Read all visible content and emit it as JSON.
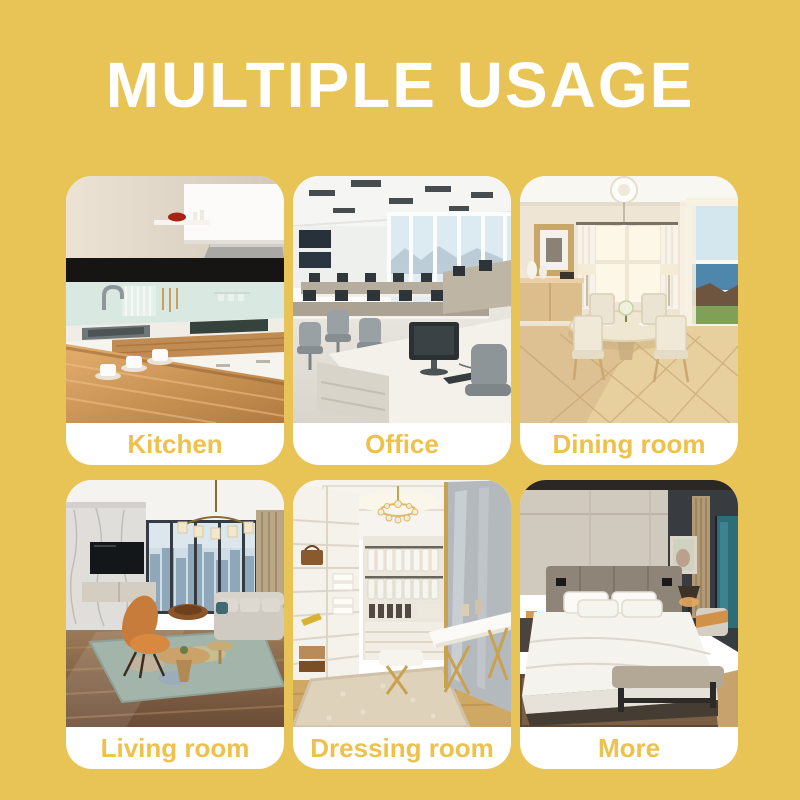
{
  "page": {
    "title": "MULTIPLE USAGE"
  },
  "theme": {
    "background": "#E8C457",
    "title_color": "#FFFFFF",
    "label_color": "#EEC14D",
    "card_background": "#FFFFFF"
  },
  "cards": [
    {
      "label": "Kitchen"
    },
    {
      "label": "Office"
    },
    {
      "label": "Dining room"
    },
    {
      "label": "Living room"
    },
    {
      "label": "Dressing room"
    },
    {
      "label": "More"
    }
  ]
}
